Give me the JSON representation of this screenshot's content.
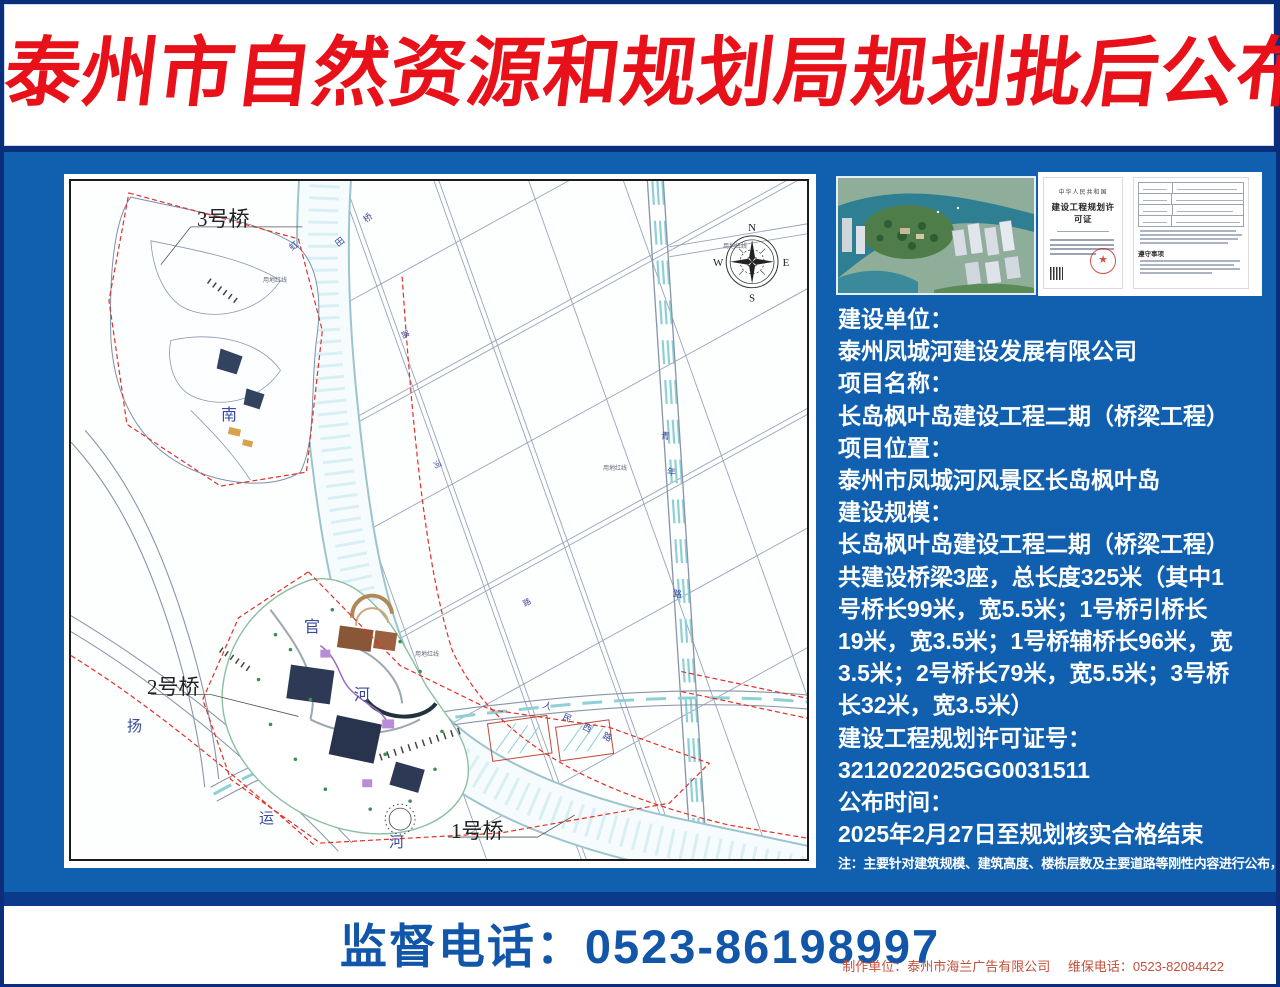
{
  "title": "泰州市自然资源和规划局规划批后公布牌",
  "colors": {
    "board_blue": "#1160b0",
    "border_navy": "#0a2e7c",
    "title_red": "#e8111a",
    "phone_blue": "#1156a8",
    "fineprint_red": "#c4503c",
    "red_dash_line": "#e23028"
  },
  "map": {
    "bridge_labels": {
      "b3": "3号桥",
      "b2": "2号桥",
      "b1": "1号桥"
    },
    "compass": {
      "n": "N",
      "e": "E",
      "s": "S",
      "w": "W"
    },
    "chars": [
      {
        "ch": "南",
        "x": 150,
        "y": 220,
        "size": 16,
        "rot": 0
      },
      {
        "ch": "官",
        "x": 233,
        "y": 432,
        "size": 16,
        "rot": 0
      },
      {
        "ch": "河",
        "x": 283,
        "y": 500,
        "size": 16,
        "rot": 0
      },
      {
        "ch": "扬",
        "x": 56,
        "y": 534,
        "size": 15,
        "rot": 0
      },
      {
        "ch": "运",
        "x": 188,
        "y": 626,
        "size": 15,
        "rot": 0
      },
      {
        "ch": "河",
        "x": 318,
        "y": 650,
        "size": 15,
        "rot": 0
      },
      {
        "ch": "人",
        "x": 472,
        "y": 518,
        "size": 9,
        "rot": 22
      },
      {
        "ch": "民",
        "x": 492,
        "y": 530,
        "size": 9,
        "rot": 24
      },
      {
        "ch": "西",
        "x": 512,
        "y": 540,
        "size": 9,
        "rot": 26
      },
      {
        "ch": "路",
        "x": 532,
        "y": 549,
        "size": 9,
        "rot": 26
      },
      {
        "ch": "虹",
        "x": 218,
        "y": 58,
        "size": 9,
        "rot": -38
      },
      {
        "ch": "田",
        "x": 264,
        "y": 54,
        "size": 9,
        "rot": -38
      },
      {
        "ch": "桥",
        "x": 292,
        "y": 30,
        "size": 9,
        "rot": -38
      },
      {
        "ch": "青",
        "x": 590,
        "y": 248,
        "size": 9,
        "rot": 5
      },
      {
        "ch": "年",
        "x": 596,
        "y": 284,
        "size": 9,
        "rot": 5
      },
      {
        "ch": "路",
        "x": 602,
        "y": 406,
        "size": 9,
        "rot": 5
      },
      {
        "ch": "路",
        "x": 330,
        "y": 148,
        "size": 8,
        "rot": 62
      },
      {
        "ch": "河",
        "x": 362,
        "y": 278,
        "size": 8,
        "rot": 62
      },
      {
        "ch": "路",
        "x": 452,
        "y": 416,
        "size": 8,
        "rot": -28
      },
      {
        "ch": "春",
        "x": 332,
        "y": 156,
        "size": 0,
        "rot": 0
      }
    ],
    "tiny_labels": [
      {
        "text": "用地红线",
        "x": 192,
        "y": 94
      },
      {
        "text": "用地红线",
        "x": 532,
        "y": 282
      },
      {
        "text": "用地红线",
        "x": 344,
        "y": 468
      },
      {
        "text": "用地红线",
        "x": 652,
        "y": 60
      }
    ]
  },
  "photos": {
    "cert_country": "中华人民共和国",
    "cert_title": "建设工程规划许可证",
    "cert_rules_heading": "遵守事项"
  },
  "info_lines": [
    "建设单位：",
    "泰州凤城河建设发展有限公司",
    "项目名称：",
    "长岛枫叶岛建设工程二期（桥梁工程）",
    "项目位置：",
    "泰州市凤城河风景区长岛枫叶岛",
    "建设规模：",
    "长岛枫叶岛建设工程二期（桥梁工程）",
    "共建设桥梁3座，总长度325米（其中1",
    "号桥长99米，宽5.5米；1号桥引桥长",
    "19米，宽3.5米；1号桥辅桥长96米，宽",
    "3.5米；2号桥长79米，宽5.5米；3号桥",
    "长32米，宽3.5米）",
    "建设工程规划许可证号：",
    "3212022025GG0031511",
    "公布时间：",
    "2025年2月27日至规划核实合格结束"
  ],
  "note": "注：主要针对建筑规模、建筑高度、楼栋层数及主要道路等刚性内容进行公布，其余部分仅为示意",
  "footer": {
    "phone": "监督电话：0523-86198997",
    "maker": "制作单位：泰州市海兰广告有限公司",
    "maintenance": "维保电话：0523-82084422"
  }
}
